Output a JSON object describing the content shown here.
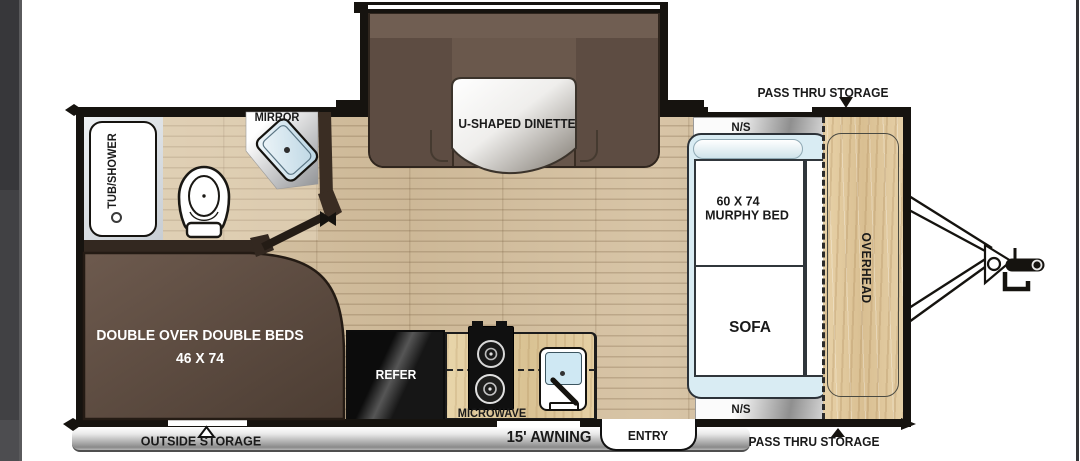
{
  "plan": {
    "storage": {
      "pass_thru_top": "PASS THRU STORAGE",
      "pass_thru_bottom": "PASS THRU STORAGE",
      "outside_storage": "OUTSIDE STORAGE"
    },
    "exterior": {
      "awning": "15' AWNING",
      "entry": "ENTRY"
    },
    "front_bedroom": {
      "ns_top": "N/S",
      "ns_bottom": "N/S",
      "murphy_size": "60 X 74",
      "murphy_name": "MURPHY BED",
      "sofa": "SOFA",
      "overhead": "OVERHEAD"
    },
    "bathroom": {
      "tub": "TUB/SHOWER",
      "mirror": "MIRROR"
    },
    "dinette": {
      "label": "U-SHAPED DINETTE"
    },
    "rear_bedroom": {
      "line1": "DOUBLE OVER DOUBLE BEDS",
      "line2": "46 X 74"
    },
    "kitchen": {
      "refer": "REFER",
      "microwave": "MICROWAVE"
    },
    "colors": {
      "wall": "#16130f",
      "floor_wood": "#d5c2a5",
      "cabinet_wood": "#e2cba0",
      "dinette_brown": "#67564b",
      "bed_brown": "#57463c",
      "mattress_blue": "#d9ecf3"
    }
  }
}
